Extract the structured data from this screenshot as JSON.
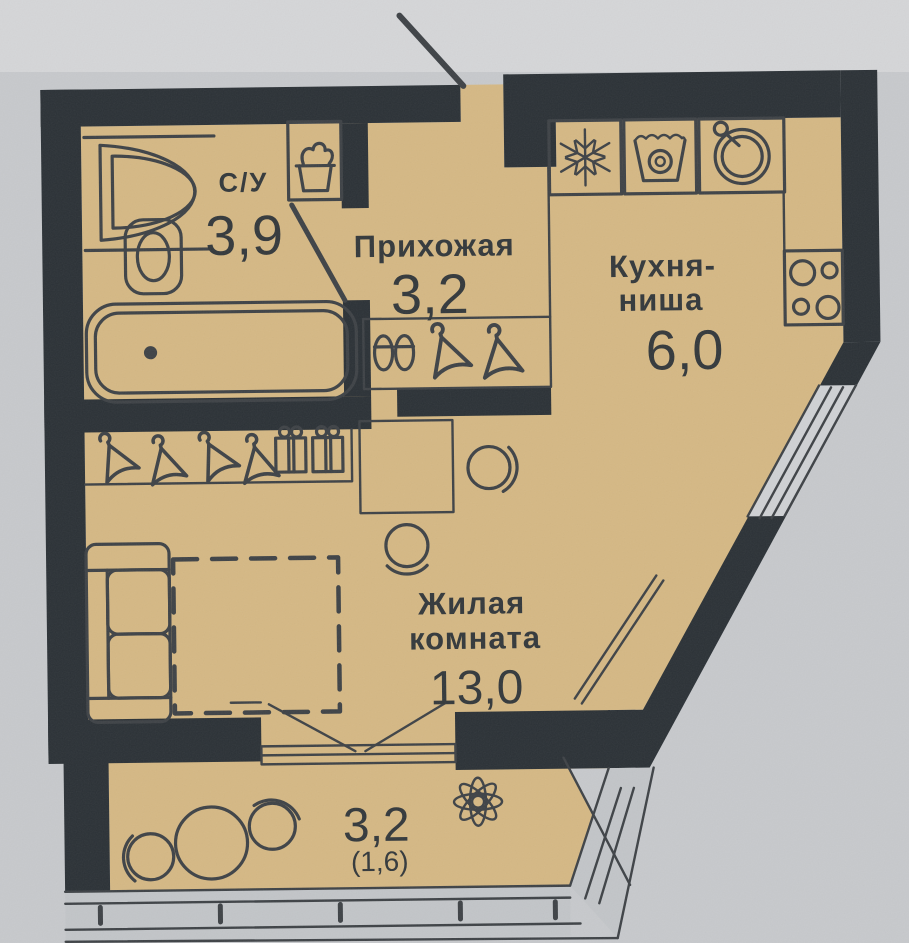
{
  "plan_type": "apartment-floor-plan",
  "colors": {
    "background": "#c7c9cc",
    "background_top": "#d5d6d8",
    "floor": "#d5b884",
    "wall": "#2b3136",
    "line": "#3e4246",
    "text": "#33383b",
    "glazing": "#c2c5c8",
    "window_glass": "#cfd1d4"
  },
  "rooms": {
    "bathroom": {
      "name": "С/У",
      "area": "3,9"
    },
    "hallway": {
      "name": "Прихожая",
      "area": "3,2"
    },
    "kitchen": {
      "name_line1": "Кухня-",
      "name_line2": "ниша",
      "area": "6,0"
    },
    "living": {
      "name_line1": "Жилая",
      "name_line2": "комната",
      "area": "13,0"
    },
    "balcony": {
      "area": "3,2",
      "area_reduced": "(1,6)"
    }
  },
  "icons": {
    "bathroom_sink": "half-round-sink-icon",
    "water_heater": "laundry-basket-icon",
    "toilet": "toilet-icon",
    "bathtub": "bathtub-icon",
    "slippers": "slippers-icon",
    "hanger": "coat-hanger-icon",
    "storage_box": "gift-box-icon",
    "fridge": "snowflake-icon",
    "washing_machine": "washer-drum-icon",
    "kitchen_sink": "round-sink-icon",
    "stove": "four-burner-stove-icon",
    "sofa": "sofa-icon",
    "bed_zone": "dashed-bed-outline",
    "desk": "desk-icon",
    "chair": "chair-icon",
    "plant": "flower-icon",
    "balcony_table": "round-table-icon",
    "radiator": "radiator-icon",
    "entrance_door": "door-leaf-line",
    "bathroom_door": "door-leaf-line",
    "balcony_door": "french-door-icon",
    "window": "glazing-band",
    "balcony_railing": "glazing-band"
  }
}
